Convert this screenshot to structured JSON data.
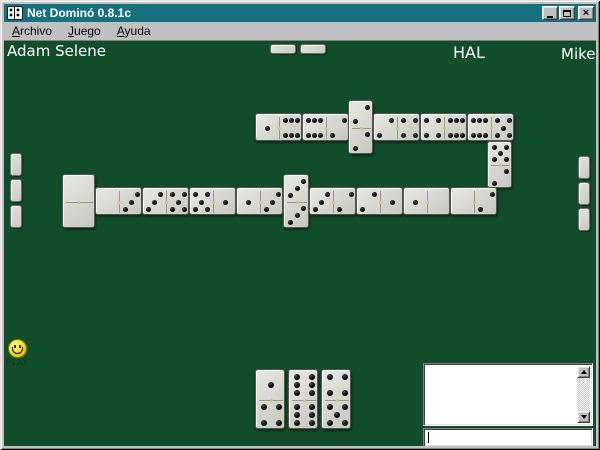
{
  "window": {
    "title": "Net Dominó 0.8.1c",
    "controls": {
      "close": "×"
    }
  },
  "menu": {
    "items": [
      {
        "label": "Archivo",
        "accel": "A"
      },
      {
        "label": "Juego",
        "accel": "J"
      },
      {
        "label": "Ayuda",
        "accel": "A"
      }
    ]
  },
  "players": {
    "opponents": [
      {
        "name": "Adam Selene",
        "side": "left",
        "tile_count": 3
      },
      {
        "name": "HAL",
        "side": "top",
        "tile_count": 2
      },
      {
        "name": "Mike",
        "side": "right",
        "tile_count": 3
      }
    ],
    "self": {
      "turn_indicator": "PLAY",
      "hand": [
        {
          "x": 251,
          "y": 328,
          "w": 30,
          "h": 60,
          "a": 1,
          "b": 4
        },
        {
          "x": 284,
          "y": 328,
          "w": 30,
          "h": 60,
          "a": 6,
          "b": 6
        },
        {
          "x": 317,
          "y": 328,
          "w": 30,
          "h": 60,
          "a": 4,
          "b": 5
        }
      ]
    }
  },
  "board_chain": [
    {
      "x": 251,
      "y": 72,
      "w": 47,
      "h": 28,
      "dir": "h",
      "a": 1,
      "b": 6
    },
    {
      "x": 298,
      "y": 72,
      "w": 47,
      "h": 28,
      "dir": "h",
      "a": 6,
      "b": 2
    },
    {
      "x": 344,
      "y": 59,
      "w": 25,
      "h": 54,
      "dir": "v",
      "a": 2,
      "b": 2
    },
    {
      "x": 369,
      "y": 72,
      "w": 47,
      "h": 28,
      "dir": "h",
      "a": 2,
      "b": 4
    },
    {
      "x": 416,
      "y": 72,
      "w": 47,
      "h": 28,
      "dir": "h",
      "a": 4,
      "b": 6
    },
    {
      "x": 463,
      "y": 72,
      "w": 47,
      "h": 28,
      "dir": "h",
      "a": 6,
      "b": 5
    },
    {
      "x": 483,
      "y": 100,
      "w": 25,
      "h": 47,
      "dir": "v",
      "a": 5,
      "b": 2
    },
    {
      "x": 58,
      "y": 133,
      "w": 33,
      "h": 54,
      "dir": "v",
      "a": 0,
      "b": 0
    },
    {
      "x": 91,
      "y": 146,
      "w": 47,
      "h": 28,
      "dir": "h",
      "a": 0,
      "b": 3
    },
    {
      "x": 138,
      "y": 146,
      "w": 47,
      "h": 28,
      "dir": "h",
      "a": 3,
      "b": 5
    },
    {
      "x": 185,
      "y": 146,
      "w": 47,
      "h": 28,
      "dir": "h",
      "a": 5,
      "b": 1
    },
    {
      "x": 232,
      "y": 146,
      "w": 47,
      "h": 28,
      "dir": "h",
      "a": 1,
      "b": 3
    },
    {
      "x": 279,
      "y": 133,
      "w": 26,
      "h": 54,
      "dir": "v",
      "a": 3,
      "b": 3
    },
    {
      "x": 305,
      "y": 146,
      "w": 47,
      "h": 28,
      "dir": "h",
      "a": 3,
      "b": 2
    },
    {
      "x": 352,
      "y": 146,
      "w": 47,
      "h": 28,
      "dir": "h",
      "a": 2,
      "b": 1
    },
    {
      "x": 399,
      "y": 146,
      "w": 47,
      "h": 28,
      "dir": "h",
      "a": 1,
      "b": 0
    },
    {
      "x": 446,
      "y": 146,
      "w": 47,
      "h": 28,
      "dir": "h",
      "a": 0,
      "b": 2
    }
  ],
  "chat": {
    "log_lines": [],
    "input_value": ""
  },
  "colors": {
    "felt": "#114d2b",
    "titlebar": "#16707e",
    "chrome": "#c0c0c0",
    "tileface": "#d9d9d3",
    "pip": "#141414",
    "accent": "#d6c36a",
    "smiley": "#f2de0a"
  }
}
